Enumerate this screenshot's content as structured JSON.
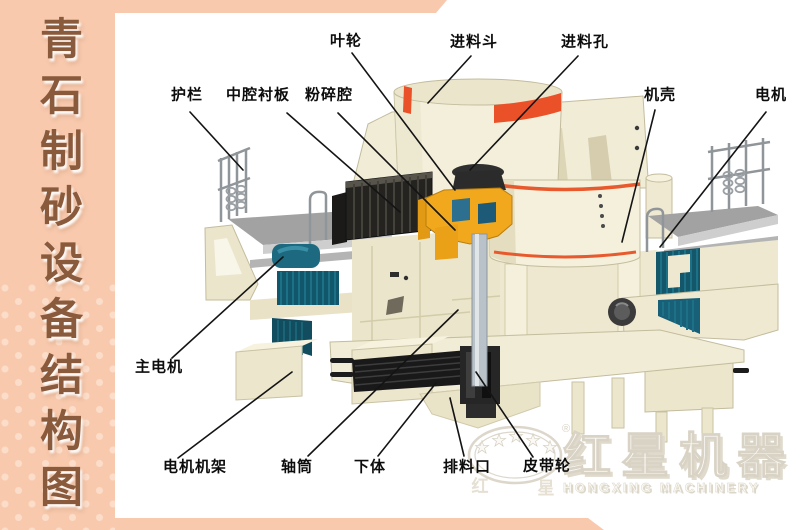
{
  "sidebar": {
    "title": "青石制砂设备结构图"
  },
  "diagram": {
    "labels": [
      {
        "id": "impeller",
        "text": "叶轮",
        "x": 346,
        "y": 41,
        "line": [
          352,
          53,
          455,
          190
        ]
      },
      {
        "id": "feed-hopper",
        "text": "进料斗",
        "x": 474,
        "y": 42,
        "line": [
          471,
          56,
          428,
          103
        ]
      },
      {
        "id": "feed-hole",
        "text": "进料孔",
        "x": 585,
        "y": 42,
        "line": [
          578,
          56,
          470,
          170
        ]
      },
      {
        "id": "guardrail",
        "text": "护栏",
        "x": 187,
        "y": 95,
        "line": [
          190,
          112,
          243,
          170
        ]
      },
      {
        "id": "middle-cavity-liner",
        "text": "中腔衬板",
        "x": 258,
        "y": 95,
        "line": [
          287,
          113,
          400,
          212
        ]
      },
      {
        "id": "crushing-chamber",
        "text": "粉碎腔",
        "x": 329,
        "y": 95,
        "line": [
          338,
          113,
          455,
          230
        ]
      },
      {
        "id": "casing",
        "text": "机壳",
        "x": 660,
        "y": 95,
        "line": [
          655,
          110,
          622,
          242
        ]
      },
      {
        "id": "motor",
        "text": "电机",
        "x": 771,
        "y": 95,
        "line": [
          766,
          112,
          660,
          247
        ]
      },
      {
        "id": "main-motor",
        "text": "主电机",
        "x": 159,
        "y": 367,
        "line": [
          172,
          358,
          283,
          257
        ]
      },
      {
        "id": "motor-frame",
        "text": "电机机架",
        "x": 195,
        "y": 467,
        "line": [
          178,
          458,
          292,
          372
        ]
      },
      {
        "id": "shaft-tube",
        "text": "轴筒",
        "x": 297,
        "y": 467,
        "line": [
          308,
          456,
          458,
          310
        ]
      },
      {
        "id": "lower-body",
        "text": "下体",
        "x": 370,
        "y": 467,
        "line": [
          378,
          456,
          436,
          383
        ]
      },
      {
        "id": "discharge-port",
        "text": "排料口",
        "x": 467,
        "y": 467,
        "line": [
          464,
          456,
          450,
          398
        ]
      },
      {
        "id": "belt-pulley",
        "text": "皮带轮",
        "x": 547,
        "y": 466,
        "line": [
          533,
          457,
          476,
          372
        ]
      }
    ]
  },
  "logo": {
    "cn": "红星机器",
    "en": "HONGXING MACHINERY",
    "registered": "®",
    "seal_left": "红",
    "seal_right": "星",
    "star": "★"
  },
  "colors": {
    "salmon": "#f8c9ad",
    "title_brown": "#8a5a3c",
    "machine_cream": "#f2edd8",
    "accent_red": "#ea5128",
    "motor_teal": "#1d6a80",
    "impeller_yellow": "#f0a81e"
  }
}
